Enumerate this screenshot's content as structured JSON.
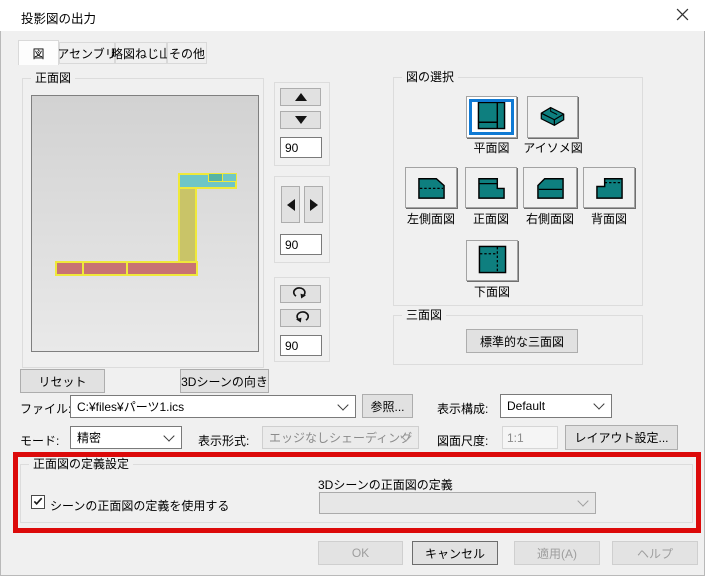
{
  "window": {
    "title": "投影図の出力"
  },
  "tabs": {
    "items": [
      {
        "label": "図"
      },
      {
        "label": "アセンブリ"
      },
      {
        "label": "略図ねじ山"
      },
      {
        "label": "その他"
      }
    ]
  },
  "front_preview": {
    "group_title": "正面図",
    "reset_button": "リセット",
    "orientation_button": "3Dシーンの向き"
  },
  "rotation_controls": {
    "updown_value": "90",
    "leftright_value": "90",
    "roll_value": "90"
  },
  "view_selection": {
    "group_title": "図の選択",
    "top": "平面図",
    "iso": "アイソメ図",
    "left": "左側面図",
    "front": "正面図",
    "right": "右側面図",
    "back": "背面図",
    "bottom": "下面図",
    "selected": "平面図"
  },
  "three_view": {
    "group_title": "三面図",
    "standard_button": "標準的な三面図"
  },
  "file_row": {
    "label": "ファイル:",
    "value": "C:¥files¥パーツ1.ics",
    "browse": "参照...",
    "display_config_label": "表示構成:",
    "display_config_value": "Default"
  },
  "mode_row": {
    "mode_label": "モード:",
    "mode_value": "精密",
    "style_label": "表示形式:",
    "style_value": "エッジなしシェーディング",
    "scale_label": "図面尺度:",
    "scale_value": "1:1",
    "layout_button": "レイアウト設定..."
  },
  "front_definition": {
    "group_title": "正面図の定義設定",
    "checkbox_label": "シーンの正面図の定義を使用する",
    "checkbox_checked": true,
    "dropdown_label": "3Dシーンの正面図の定義",
    "dropdown_value": ""
  },
  "footer": {
    "ok": "OK",
    "cancel": "キャンセル",
    "apply": "適用(A)",
    "help": "ヘルプ"
  },
  "colors": {
    "accent_blue": "#0f7ad4",
    "icon_teal": "#0e7f7f",
    "preview_teal": "#6fc6c6",
    "preview_teal_dark": "#57b3a3",
    "preview_olive": "#c9c468",
    "preview_red": "#c87373",
    "outline_yellow": "#efe93a",
    "annotation_red": "#dc0a0a"
  }
}
